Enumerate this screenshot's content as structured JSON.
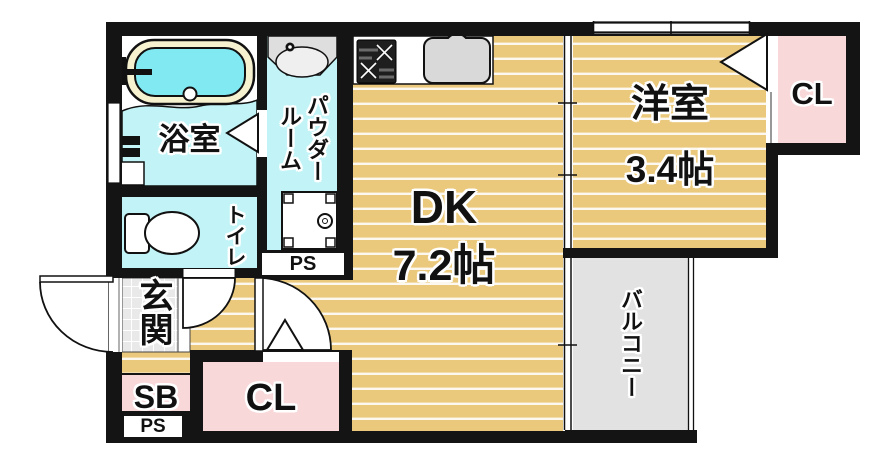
{
  "plan_title": "apartment-floor-plan",
  "rooms": {
    "bath": {
      "label": "浴室"
    },
    "powder_room": {
      "label": "パウダールーム"
    },
    "toilet": {
      "label": "トイレ"
    },
    "entrance": {
      "label": "玄関"
    },
    "dining_kitchen": {
      "label": "DK",
      "size": "7.2帖"
    },
    "western_room": {
      "label": "洋室",
      "size": "3.4帖"
    },
    "closet_top": {
      "label": "CL"
    },
    "closet_bottom": {
      "label": "CL"
    },
    "shoe_box": {
      "label": "SB"
    },
    "pipe_space_upper": {
      "label": "PS"
    },
    "pipe_space_lower": {
      "label": "PS"
    },
    "balcony": {
      "label": "バルコニー"
    }
  },
  "colors": {
    "wall": "#141414",
    "wood_floor": "#eac97d",
    "floor_stripe": "#ffffff",
    "wet_area": "#c2f4f7",
    "bathtub_water": "#80e9f2",
    "bathtub_rim": "#f6f1cf",
    "closet_pink": "#f9d8da",
    "balcony_gray": "#e2e2e2",
    "entrance_tile": "#e9e9e9"
  }
}
